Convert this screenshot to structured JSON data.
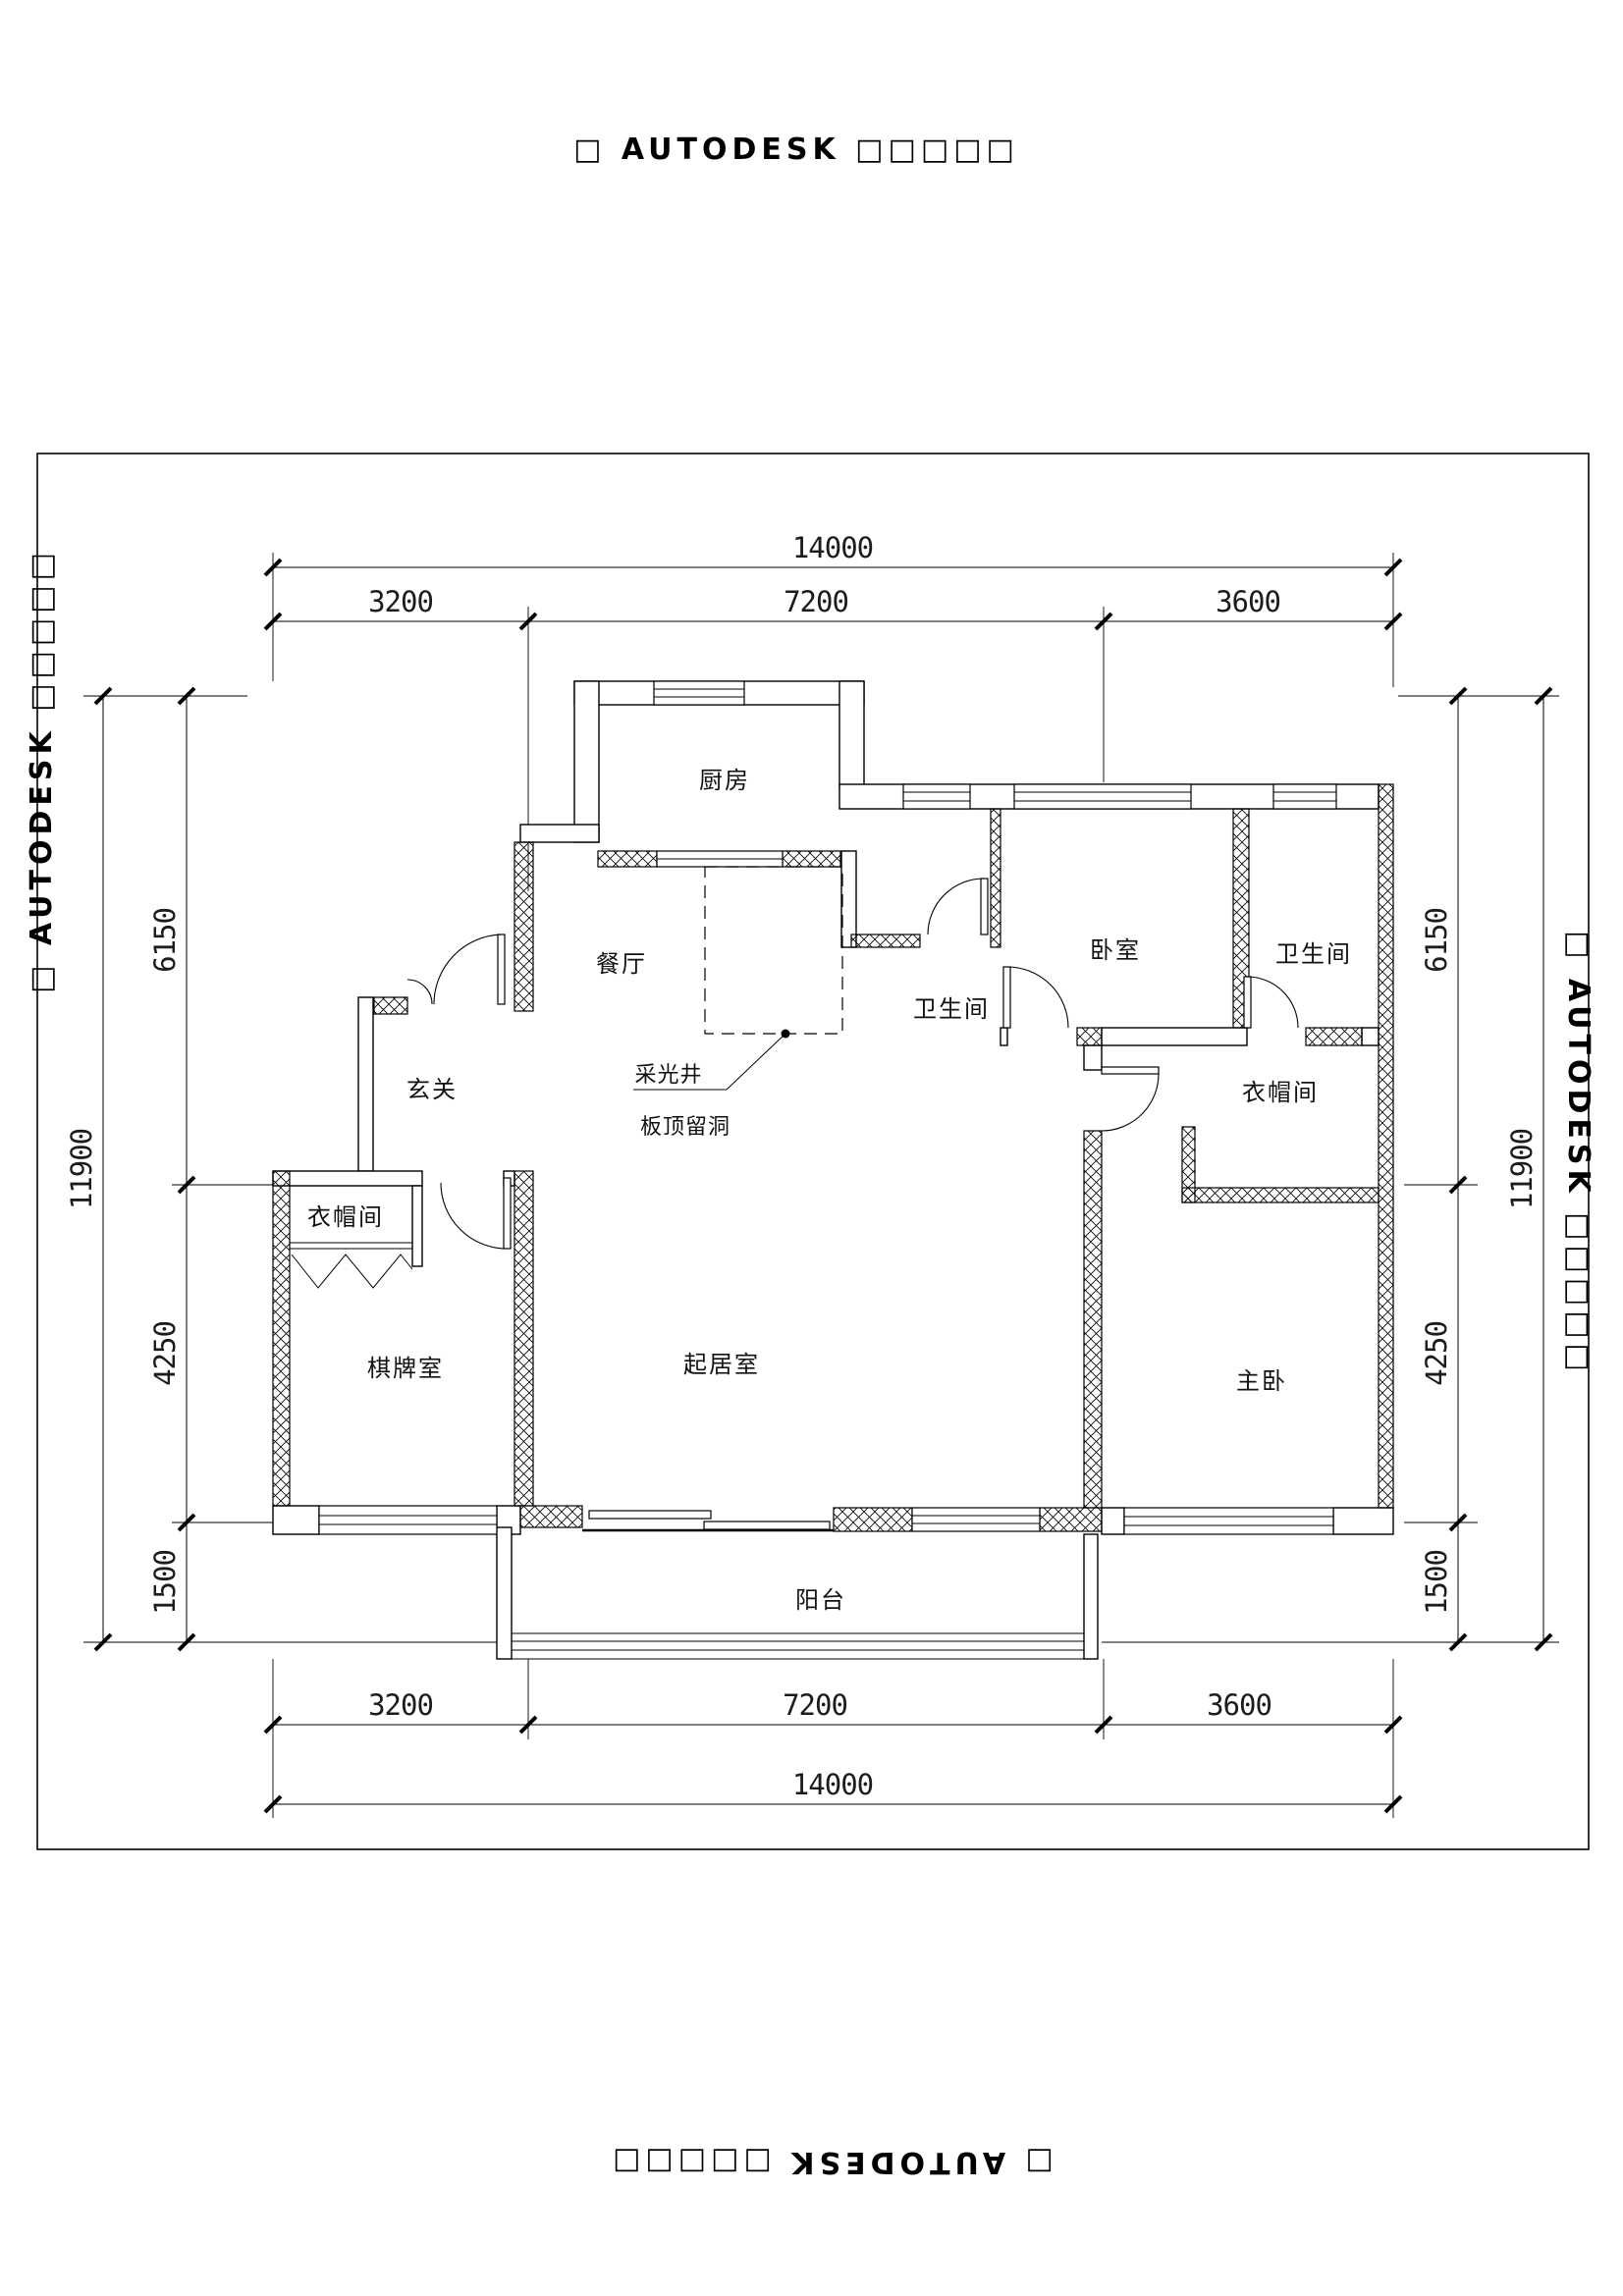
{
  "watermark": {
    "stamp": "□ AUTODESK □□□□□"
  },
  "plan": {
    "rooms": {
      "kitchen": "厨房",
      "dining": "餐厅",
      "bath_top": "卫生间",
      "bedroom": "卧室",
      "bath_right": "卫生间",
      "closet_right": "衣帽间",
      "foyer": "玄关",
      "closet_left": "衣帽间",
      "game_room": "棋牌室",
      "living": "起居室",
      "master_bedroom": "主卧",
      "balcony": "阳台"
    },
    "annotations": {
      "light_well": "采光井",
      "slab_opening": "板顶留洞"
    }
  },
  "dimensions": {
    "horizontal": {
      "overall": "14000",
      "segments": [
        "3200",
        "7200",
        "3600"
      ]
    },
    "vertical": {
      "overall": "11900",
      "segments": [
        "6150",
        "4250",
        "1500"
      ]
    }
  }
}
